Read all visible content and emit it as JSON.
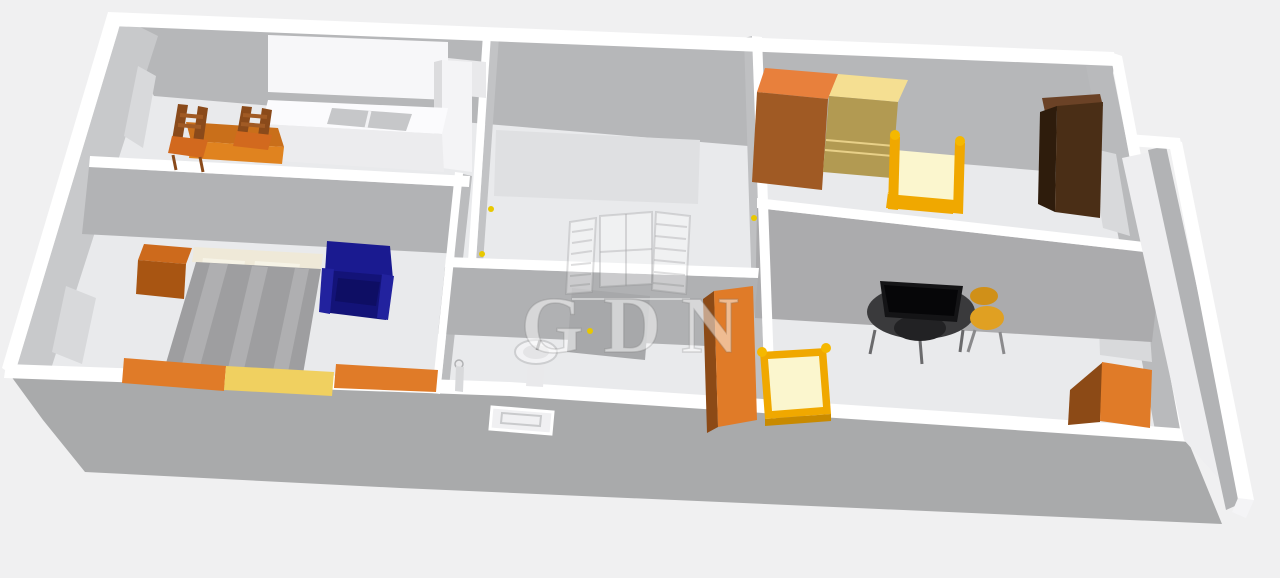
{
  "watermark": {
    "text": "GDN",
    "logo": "open-window-with-shutters-icon"
  },
  "scene": {
    "type": "3d-floor-plan-render",
    "view": "perspective-from-above"
  },
  "colors": {
    "background": "#f0f0f1",
    "floor": "#e9eaec",
    "wall_top": "#ffffff",
    "wall_light": "#c8c9cb",
    "wall_mid": "#b6b7b9",
    "wall_dark": "#a9aaab",
    "window_glass": "#d8d9db",
    "orange": "#e07b28",
    "orange_front": "#a05a24",
    "orange_deep": "#8c4a16",
    "table_orange_top": "#c96f1a",
    "table_orange_front": "#e0831f",
    "wood_brown": "#8a4a1a",
    "yellow_pale": "#f5df92",
    "yellow_tan": "#b29a52",
    "yellow_mid": "#f0d060",
    "gold": "#f0a800",
    "mattress_pale": "#fbf6ce",
    "navy": "#1a1a90",
    "navy_dark": "#131378",
    "blanket_gray": "#9e9ea0",
    "dark_brown": "#4a2e16",
    "dark_brown_side": "#2e1c0c",
    "dark_brown_top": "#6b4226",
    "desk_black": "#141416",
    "chair_yellow": "#e0a022",
    "white_furniture": "#f7f7f9",
    "sink_steel": "#c6c7c9",
    "handle_yellow": "#e8c800"
  },
  "rooms": {
    "kitchen": {
      "name": "kitchen",
      "furniture": [
        "wall-cabinet",
        "kitchen-counter-with-sink",
        "tall-cabinet",
        "dining-table",
        "wooden-chair",
        "wooden-chair"
      ]
    },
    "bedroom_left": {
      "name": "bedroom-left",
      "furniture": [
        "double-bed",
        "nightstand",
        "armchair",
        "sideboard-orange",
        "sideboard-yellow",
        "sideboard-orange"
      ]
    },
    "hallway": {
      "name": "hallway-middle",
      "furniture": [
        "wall-panel"
      ]
    },
    "bedroom_right": {
      "name": "bedroom-top-right",
      "furniture": [
        "wardrobe-orange",
        "wardrobe-yellow",
        "single-bed",
        "wardrobe-dark-brown"
      ]
    },
    "bathroom": {
      "name": "bathroom",
      "furniture": [
        "pedestal-sink",
        "shower-panel",
        "cabinet-orange",
        "wall-fixture"
      ]
    },
    "kids_room": {
      "name": "room-bottom-right",
      "furniture": [
        "crib",
        "desk-with-monitor",
        "desk-chair",
        "cabinet-orange"
      ]
    },
    "balcony": {
      "name": "balcony-strip",
      "furniture": []
    }
  }
}
